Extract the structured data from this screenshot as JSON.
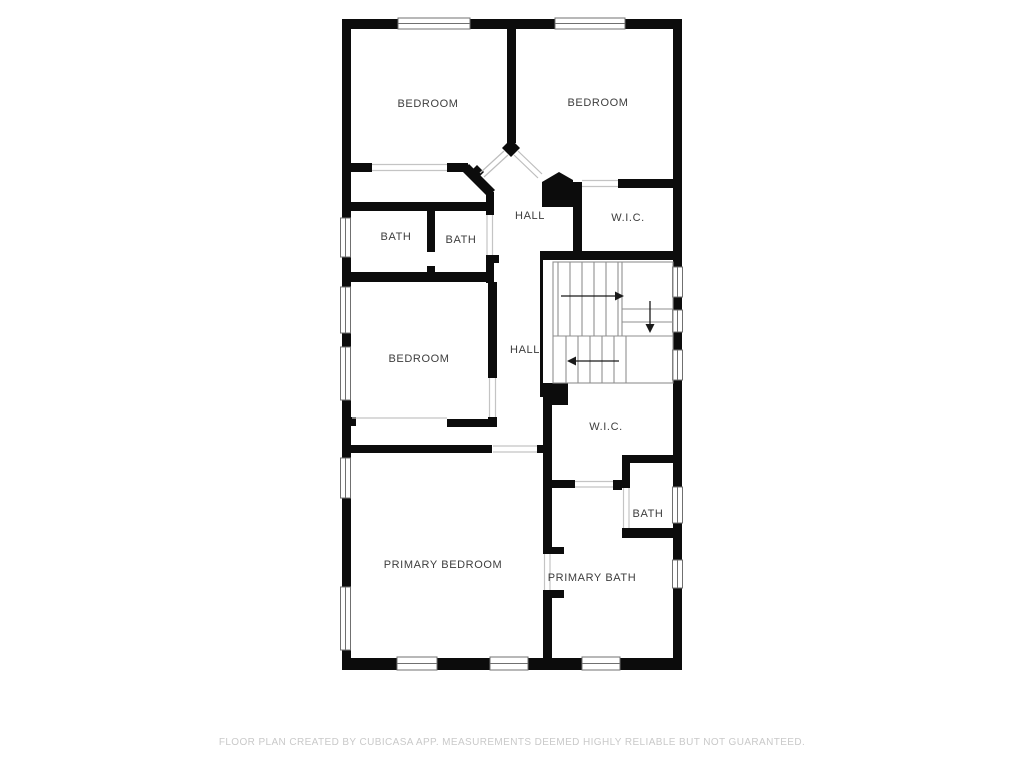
{
  "title": "Second floor plan",
  "floor_plan": {
    "rooms": [
      {
        "id": "bedroom-top-left",
        "label": "BEDROOM"
      },
      {
        "id": "bedroom-top-right",
        "label": "BEDROOM"
      },
      {
        "id": "hall-upper",
        "label": "HALL"
      },
      {
        "id": "wic-upper",
        "label": "W.I.C."
      },
      {
        "id": "bath-left",
        "label": "BATH"
      },
      {
        "id": "bath-center",
        "label": "BATH"
      },
      {
        "id": "bedroom-middle",
        "label": "BEDROOM"
      },
      {
        "id": "hall-lower",
        "label": "HALL"
      },
      {
        "id": "wic-lower",
        "label": "W.I.C."
      },
      {
        "id": "bath-small",
        "label": "BATH"
      },
      {
        "id": "primary-bedroom",
        "label": "PRIMARY BEDROOM"
      },
      {
        "id": "primary-bath",
        "label": "PRIMARY BATH"
      }
    ],
    "stairs": {
      "arrows": [
        {
          "direction": "right"
        },
        {
          "direction": "down"
        },
        {
          "direction": "left"
        }
      ]
    },
    "colors": {
      "wall": "#0c0c0c",
      "stair_line": "#8f8f8f",
      "opening_line": "#c4c4c4",
      "door_swing_line": "#bdbdbd",
      "label_text": "#3d3d3d",
      "footer_text": "#c9c9c9",
      "background": "#ffffff"
    }
  },
  "footer": {
    "disclaimer": "FLOOR PLAN CREATED BY CUBICASA APP. MEASUREMENTS DEEMED HIGHLY RELIABLE BUT NOT GUARANTEED."
  }
}
